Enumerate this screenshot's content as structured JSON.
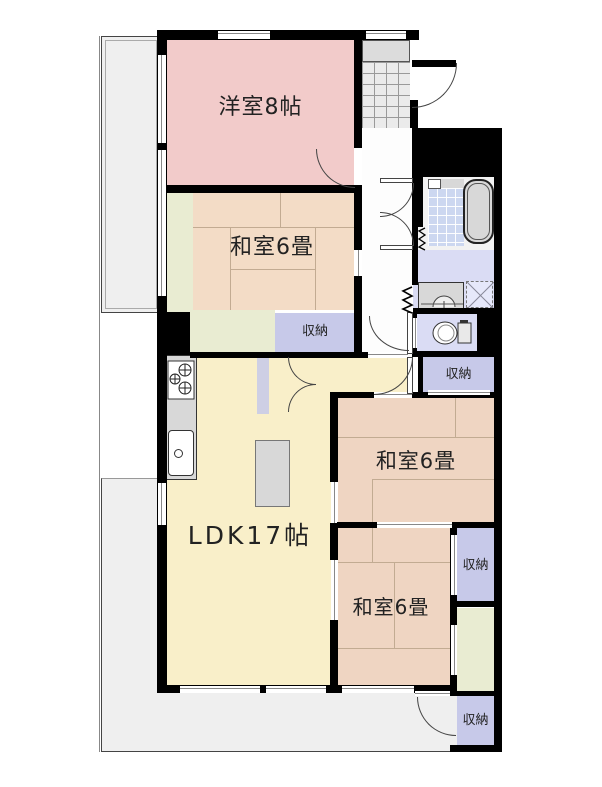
{
  "rooms": {
    "western": {
      "label": "洋室8帖"
    },
    "tatami_nw": {
      "label": "和室6畳"
    },
    "ldk": {
      "label": "LDK17帖"
    },
    "tatami_e": {
      "label": "和室6畳"
    },
    "tatami_s": {
      "label": "和室6畳"
    }
  },
  "storage": {
    "label": "収納"
  },
  "colors": {
    "western": "#f2cbca",
    "tatami": "#f3dcc6",
    "tatami_dark": "#efd5c2",
    "ldk": "#f9efc9",
    "green": "#e9ecd2",
    "storage": "#c7c9e9",
    "wash": "#dadcf4",
    "tile": "#ccd7f0",
    "balcony": "#efefef",
    "porch": "#dcdcdc",
    "fixture": "#d8d8d8",
    "wall": "#000000"
  }
}
